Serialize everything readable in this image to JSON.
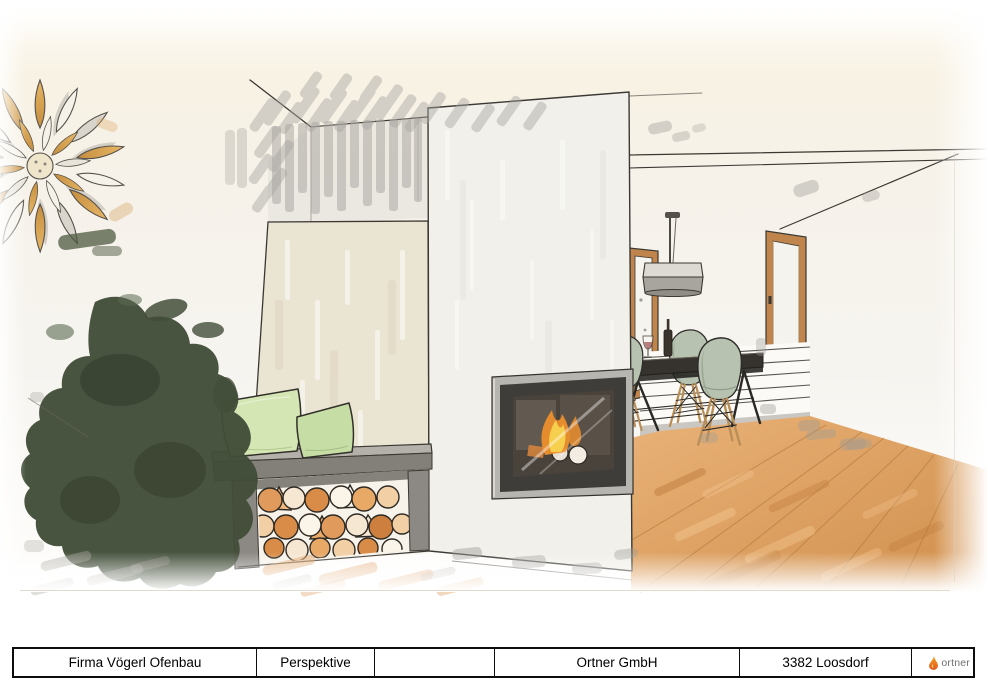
{
  "title_block": {
    "client": "Firma Vögerl Ofenbau",
    "view": "Perspektive",
    "field3": "",
    "company": "Ortner GmbH",
    "location": "3382 Loosdorf"
  },
  "logo": {
    "text": "ortner"
  },
  "palette": {
    "paper": "#f6f2e8",
    "sketch_line": "#3b3833",
    "accent_wall": "#eae4d2",
    "chimney": "#f1f0ea",
    "bench_gray": "#8c8984",
    "pillow_green": "#d4e6b4",
    "pillow_green2": "#c6dda6",
    "chair_sage": "#b7c3b0",
    "wood_floor": "#dfa265",
    "log_orange": "#e09a5c",
    "flame_yellow": "#f7cf4e",
    "flame_orange": "#ec8f2d",
    "marker_gray": "#a3a19c",
    "window_wood": "#c0854c",
    "plant_green": "#424d38",
    "flower_gold": "#d9a85c",
    "logo_flame_top": "#f6a11e",
    "logo_flame_bottom": "#e2571c",
    "logo_text": "#6f6f6f"
  },
  "scene": {
    "objects": [
      "flower-wall-decor",
      "plant-silhouette",
      "accent-wall",
      "chimney-panel",
      "fireplace-insert",
      "fire-flames",
      "wood-bench",
      "firewood-storage",
      "pillows",
      "dining-table",
      "dining-chairs",
      "pendant-lamp",
      "window-left",
      "window-right",
      "wood-floor",
      "ceiling-lines",
      "marker-accents"
    ]
  }
}
